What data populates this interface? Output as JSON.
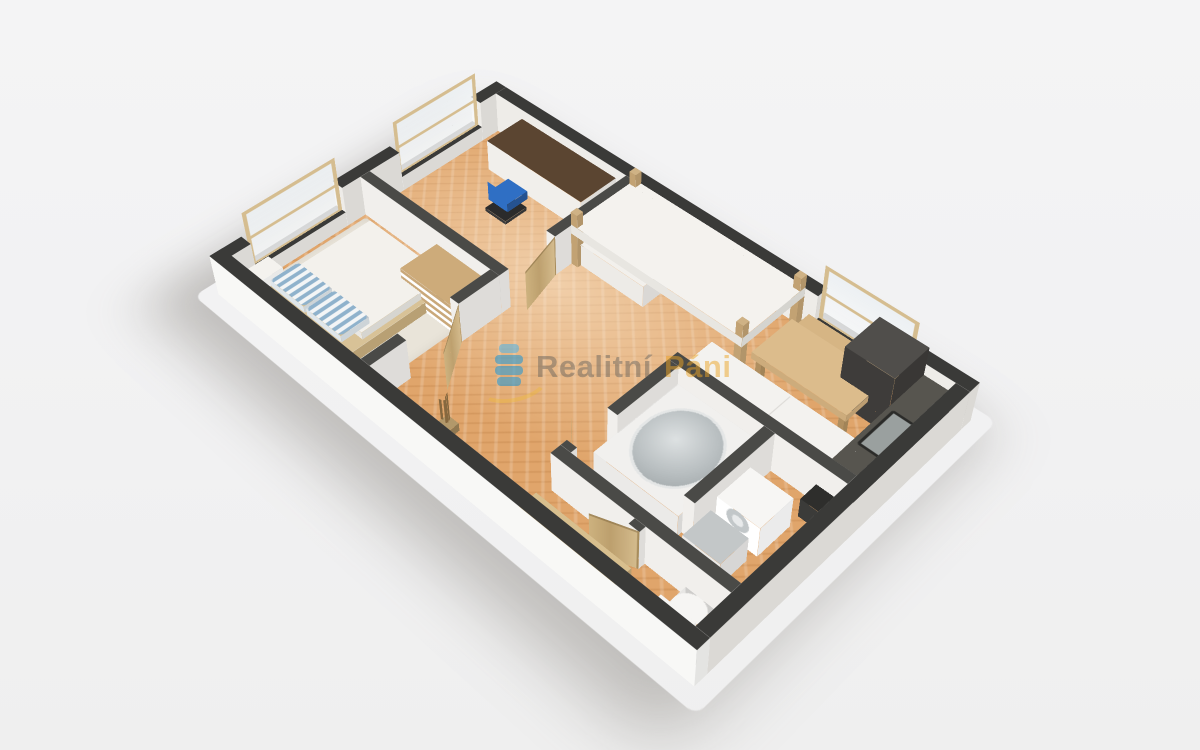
{
  "page": {
    "background": "#f2f2f3",
    "description": "3D isometric floor plan render of an apartment"
  },
  "watermark": {
    "brand_word1": "Realitní",
    "brand_word2": "Páni",
    "word1_color": "rgba(92,90,88,0.44)",
    "word2_color": "rgba(236,163,38,0.5)",
    "logo_blue": "rgba(44,152,206,0.6)",
    "logo_blue_light": "rgba(90,180,225,0.6)",
    "swoosh_color": "rgba(238,186,52,0.38)"
  },
  "floorplan": {
    "plan_size": {
      "w": 660,
      "h": 400
    },
    "wall_height": 55,
    "palette": {
      "wall_top_outer": "#3a3a38",
      "wall_side_outer": "#eeece8",
      "wall_top_inner": "#4a4a47",
      "wall_side_inner": "#f1efec",
      "floor_parquet": "#e0a56b",
      "wood": "#cdb285",
      "dark_kitchen": "#454440",
      "accent_chair_blue": "#2f6fc4",
      "pillow_blue": "#8fb2cc"
    },
    "floors": [
      {
        "n": "ground-shadow",
        "x": -18,
        "y": -18,
        "w": 696,
        "h": 436,
        "cls": "shadow"
      },
      {
        "n": "floor-parquet-main",
        "x": 16,
        "y": 16,
        "w": 628,
        "h": 368,
        "cls": "parquet"
      },
      {
        "n": "bedroom-rug",
        "x": 20,
        "y": 218,
        "w": 196,
        "h": 162,
        "cls": "rug"
      }
    ],
    "walls": [
      {
        "n": "wall-outer-left-a",
        "x": 0,
        "y": 0,
        "w": 16,
        "h": 40,
        "H": 55,
        "kind": "outer"
      },
      {
        "n": "wall-outer-left-sill-study",
        "x": 0,
        "y": 40,
        "w": 16,
        "h": 120,
        "H": 20,
        "kind": "outer"
      },
      {
        "n": "wall-outer-left-b",
        "x": 0,
        "y": 160,
        "w": 16,
        "h": 80,
        "H": 55,
        "kind": "outer"
      },
      {
        "n": "wall-outer-left-sill-bedroom",
        "x": 0,
        "y": 240,
        "w": 16,
        "h": 120,
        "H": 20,
        "kind": "outer"
      },
      {
        "n": "wall-outer-left-c",
        "x": 0,
        "y": 360,
        "w": 16,
        "h": 40,
        "H": 55,
        "kind": "outer"
      },
      {
        "n": "wall-outer-top-a",
        "x": 16,
        "y": 0,
        "w": 464,
        "h": 16,
        "H": 55,
        "kind": "outer"
      },
      {
        "n": "wall-outer-top-sill-kitchen",
        "x": 480,
        "y": 0,
        "w": 112,
        "h": 16,
        "H": 20,
        "kind": "outer"
      },
      {
        "n": "wall-outer-top-b",
        "x": 592,
        "y": 0,
        "w": 68,
        "h": 16,
        "H": 55,
        "kind": "outer"
      },
      {
        "n": "wall-outer-right",
        "x": 644,
        "y": 16,
        "w": 16,
        "h": 368,
        "H": 55,
        "kind": "outer"
      },
      {
        "n": "wall-outer-front",
        "x": 0,
        "y": 384,
        "w": 660,
        "h": 16,
        "H": 55,
        "kind": "outer",
        "side": "#f8f8f6"
      },
      {
        "n": "wall-study-bedroom",
        "x": 16,
        "y": 202,
        "w": 216,
        "h": 13,
        "H": 55,
        "kind": "inner"
      },
      {
        "n": "wall-study-living",
        "x": 219,
        "y": 16,
        "w": 13,
        "h": 120,
        "H": 55,
        "kind": "inner"
      },
      {
        "n": "wall-bedroom-hall-a",
        "x": 219,
        "y": 215,
        "w": 13,
        "h": 55,
        "H": 55,
        "kind": "inner"
      },
      {
        "n": "wall-bedroom-hall-b",
        "x": 219,
        "y": 338,
        "w": 13,
        "h": 46,
        "H": 55,
        "kind": "inner"
      },
      {
        "n": "wall-bathroom-top",
        "x": 430,
        "y": 168,
        "w": 214,
        "h": 13,
        "H": 55,
        "kind": "inner"
      },
      {
        "n": "wall-bathroom-left-a",
        "x": 430,
        "y": 181,
        "w": 13,
        "h": 84,
        "H": 55,
        "kind": "inner"
      },
      {
        "n": "wall-bathroom-left-stub",
        "x": 430,
        "y": 318,
        "w": 13,
        "h": 8,
        "H": 55,
        "kind": "inner"
      },
      {
        "n": "wall-bathroom-bottom",
        "x": 430,
        "y": 326,
        "w": 214,
        "h": 13,
        "H": 55,
        "kind": "inner"
      },
      {
        "n": "wall-bathroom-divider",
        "x": 548,
        "y": 181,
        "w": 13,
        "h": 110,
        "H": 55,
        "kind": "inner"
      },
      {
        "n": "wall-wc-left-stub",
        "x": 534,
        "y": 339,
        "w": 13,
        "h": 8,
        "H": 55,
        "kind": "inner"
      }
    ],
    "boxes": [
      {
        "n": "bed-frame",
        "x": 44,
        "y": 228,
        "w": 132,
        "h": 150,
        "H": 16,
        "top": "#d8c297",
        "side": "#c8ae7e"
      },
      {
        "n": "bed-mattress",
        "x": 50,
        "y": 234,
        "w": 120,
        "h": 112,
        "z0": 16,
        "H": 10,
        "top": "#f3f1ec",
        "side": "#e9e7e2"
      },
      {
        "n": "bed-pillow-1",
        "x": 54,
        "y": 332,
        "w": 54,
        "h": 36,
        "z0": 26,
        "H": 9,
        "cls": "pillow",
        "side": "#dfe6eb"
      },
      {
        "n": "bed-pillow-2",
        "x": 112,
        "y": 332,
        "w": 54,
        "h": 36,
        "z0": 26,
        "H": 9,
        "cls": "pillow",
        "side": "#dfe6eb"
      },
      {
        "n": "nightstand",
        "x": 18,
        "y": 344,
        "w": 24,
        "h": 30,
        "H": 28,
        "top": "#f4f2ee",
        "side": "#fdfdfc"
      },
      {
        "n": "dresser",
        "x": 140,
        "y": 218,
        "w": 78,
        "h": 50,
        "H": 40,
        "top": "#cdab7a",
        "side": "#fdfdfc",
        "cls": "drawers"
      },
      {
        "n": "desk",
        "x": 58,
        "y": 16,
        "w": 146,
        "h": 54,
        "H": 42,
        "top": "#5b4531",
        "side": "#f1efeb"
      },
      {
        "n": "desk-chair-base",
        "x": 106,
        "y": 88,
        "w": 32,
        "h": 32,
        "H": 5,
        "top": "#2b2b2b",
        "side": "#3a3a3a"
      },
      {
        "n": "desk-chair-seat",
        "x": 108,
        "y": 86,
        "w": 30,
        "h": 30,
        "z0": 16,
        "H": 11,
        "top": "#2f6fc4",
        "side": "#28599c"
      },
      {
        "n": "loft-bed-post-1",
        "x": 232,
        "y": 16,
        "w": 9,
        "h": 9,
        "H": 74,
        "top": "#cfb285",
        "side": "#c2a273"
      },
      {
        "n": "loft-bed-post-2",
        "x": 455,
        "y": 16,
        "w": 9,
        "h": 9,
        "H": 74,
        "top": "#cfb285",
        "side": "#c2a273"
      },
      {
        "n": "loft-bed-post-3",
        "x": 232,
        "y": 104,
        "w": 9,
        "h": 9,
        "H": 74,
        "top": "#cfb285",
        "side": "#c2a273"
      },
      {
        "n": "loft-bed-post-4",
        "x": 455,
        "y": 104,
        "w": 9,
        "h": 9,
        "H": 74,
        "top": "#cfb285",
        "side": "#c2a273"
      },
      {
        "n": "loft-bed-platform",
        "x": 232,
        "y": 16,
        "w": 232,
        "h": 97,
        "z0": 44,
        "H": 13,
        "top": "#f4f2ee",
        "side": "#e8e6e1"
      },
      {
        "n": "loft-bed-shelf",
        "x": 238,
        "y": 22,
        "w": 92,
        "h": 86,
        "H": 30,
        "top": "#f2f0ec",
        "side": "#edebe7"
      },
      {
        "n": "dining-bench",
        "x": 472,
        "y": 16,
        "w": 112,
        "h": 20,
        "H": 24,
        "top": "#d6b584",
        "side": "#c6a574"
      },
      {
        "n": "dining-table",
        "x": 470,
        "y": 42,
        "w": 116,
        "h": 62,
        "z0": 26,
        "H": 9,
        "top": "#dcbc8c",
        "side": "#cdac7c"
      },
      {
        "n": "table-leg-1",
        "x": 474,
        "y": 46,
        "w": 7,
        "h": 7,
        "H": 26,
        "top": "#b08f60",
        "side": "#b08f60"
      },
      {
        "n": "table-leg-2",
        "x": 576,
        "y": 46,
        "w": 7,
        "h": 7,
        "H": 26,
        "top": "#b08f60",
        "side": "#b08f60"
      },
      {
        "n": "table-leg-3",
        "x": 474,
        "y": 94,
        "w": 7,
        "h": 7,
        "H": 26,
        "top": "#b08f60",
        "side": "#b08f60"
      },
      {
        "n": "table-leg-4",
        "x": 576,
        "y": 94,
        "w": 7,
        "h": 7,
        "H": 26,
        "top": "#b08f60",
        "side": "#b08f60"
      },
      {
        "n": "stool-1",
        "x": 482,
        "y": 112,
        "w": 28,
        "h": 24,
        "H": 22,
        "top": "#d2b080",
        "side": "#c0a070"
      },
      {
        "n": "stool-2",
        "x": 528,
        "y": 112,
        "w": 28,
        "h": 24,
        "H": 22,
        "top": "#d2b080",
        "side": "#c0a070"
      },
      {
        "n": "kitchen-cabinets-white",
        "x": 436,
        "y": 124,
        "w": 198,
        "h": 44,
        "H": 40,
        "top": "#f3f2ef",
        "side": "#fbfaf8",
        "detail": "seam"
      },
      {
        "n": "kitchen-tall-unit",
        "x": 552,
        "y": 16,
        "w": 58,
        "h": 54,
        "H": 78,
        "top": "#504e4b",
        "side": "#3e3c3a"
      },
      {
        "n": "kitchen-counter",
        "x": 610,
        "y": 16,
        "w": 34,
        "h": 150,
        "H": 40,
        "top": "#57554f",
        "side": "#413f3d",
        "detail": "sink"
      },
      {
        "n": "trash-bin",
        "x": 612,
        "y": 178,
        "w": 26,
        "h": 26,
        "H": 26,
        "top": "#2e2e2c",
        "side": "#3b3b39"
      },
      {
        "n": "bathtub",
        "x": 443,
        "y": 181,
        "w": 105,
        "h": 116,
        "H": 30,
        "top": "#f1f0ee",
        "side": "#ebeae8",
        "detail": "basin"
      },
      {
        "n": "washing-machine",
        "x": 564,
        "y": 218,
        "w": 50,
        "h": 46,
        "H": 42,
        "top": "#f7f6f4",
        "side": "#ffffff",
        "detail": "drum"
      },
      {
        "n": "bathroom-sink",
        "x": 566,
        "y": 274,
        "w": 44,
        "h": 38,
        "H": 34,
        "top": "#c3c7c8",
        "side": "#eae9e7"
      },
      {
        "n": "toilet-bowl",
        "x": 596,
        "y": 340,
        "w": 34,
        "h": 30,
        "H": 16,
        "top": "#f6f5f3",
        "side": "#eeedeb",
        "r": "50%"
      },
      {
        "n": "toilet-tank",
        "x": 592,
        "y": 368,
        "w": 40,
        "h": 14,
        "H": 30,
        "top": "#f6f5f3",
        "side": "#fdfdfb"
      },
      {
        "n": "entry-bench",
        "x": 436,
        "y": 364,
        "w": 118,
        "h": 26,
        "H": 26,
        "top": "#d8bf8e",
        "side": "#c9ab79"
      },
      {
        "n": "plant-pot",
        "x": 300,
        "y": 350,
        "w": 16,
        "h": 16,
        "H": 11,
        "top": "#b2986a",
        "side": "#9c8258"
      }
    ],
    "panels": [
      {
        "n": "door-bedroom",
        "x": 232,
        "y": 270,
        "len": 66,
        "H": 56,
        "a": 55,
        "cls": "door"
      },
      {
        "n": "door-study",
        "x": 232,
        "y": 136,
        "len": 60,
        "H": 56,
        "a": 75,
        "cls": "door"
      },
      {
        "n": "door-bathroom",
        "x": 436,
        "y": 318,
        "len": 62,
        "H": 56,
        "a": 225,
        "cls": "door"
      },
      {
        "n": "door-wc",
        "x": 547,
        "y": 347,
        "len": 48,
        "H": 56,
        "a": 160,
        "cls": "door"
      },
      {
        "n": "window-study",
        "x": 10,
        "y": 40,
        "len": 120,
        "H": 76,
        "z0": 18,
        "a": 90,
        "cls": "window"
      },
      {
        "n": "window-bedroom",
        "x": 10,
        "y": 240,
        "len": 120,
        "H": 76,
        "z0": 18,
        "a": 90,
        "cls": "window"
      },
      {
        "n": "window-kitchen",
        "x": 480,
        "y": 10,
        "len": 112,
        "H": 76,
        "z0": 18,
        "a": 0,
        "cls": "window"
      },
      {
        "n": "desk-chair-back",
        "x": 108,
        "y": 116,
        "len": 30,
        "H": 26,
        "z0": 16,
        "a": 0,
        "cls": "chairback"
      },
      {
        "n": "plant-twig-1",
        "x": 304,
        "y": 354,
        "len": 3,
        "H": 46,
        "a": 15,
        "cls": "twig"
      },
      {
        "n": "plant-twig-2",
        "x": 306,
        "y": 352,
        "len": 3,
        "H": 50,
        "a": 70,
        "cls": "twig"
      },
      {
        "n": "plant-twig-3",
        "x": 308,
        "y": 356,
        "len": 3,
        "H": 44,
        "a": 125,
        "cls": "twig"
      },
      {
        "n": "plant-twig-4",
        "x": 302,
        "y": 357,
        "len": 3,
        "H": 40,
        "a": 160,
        "cls": "twig"
      }
    ]
  }
}
